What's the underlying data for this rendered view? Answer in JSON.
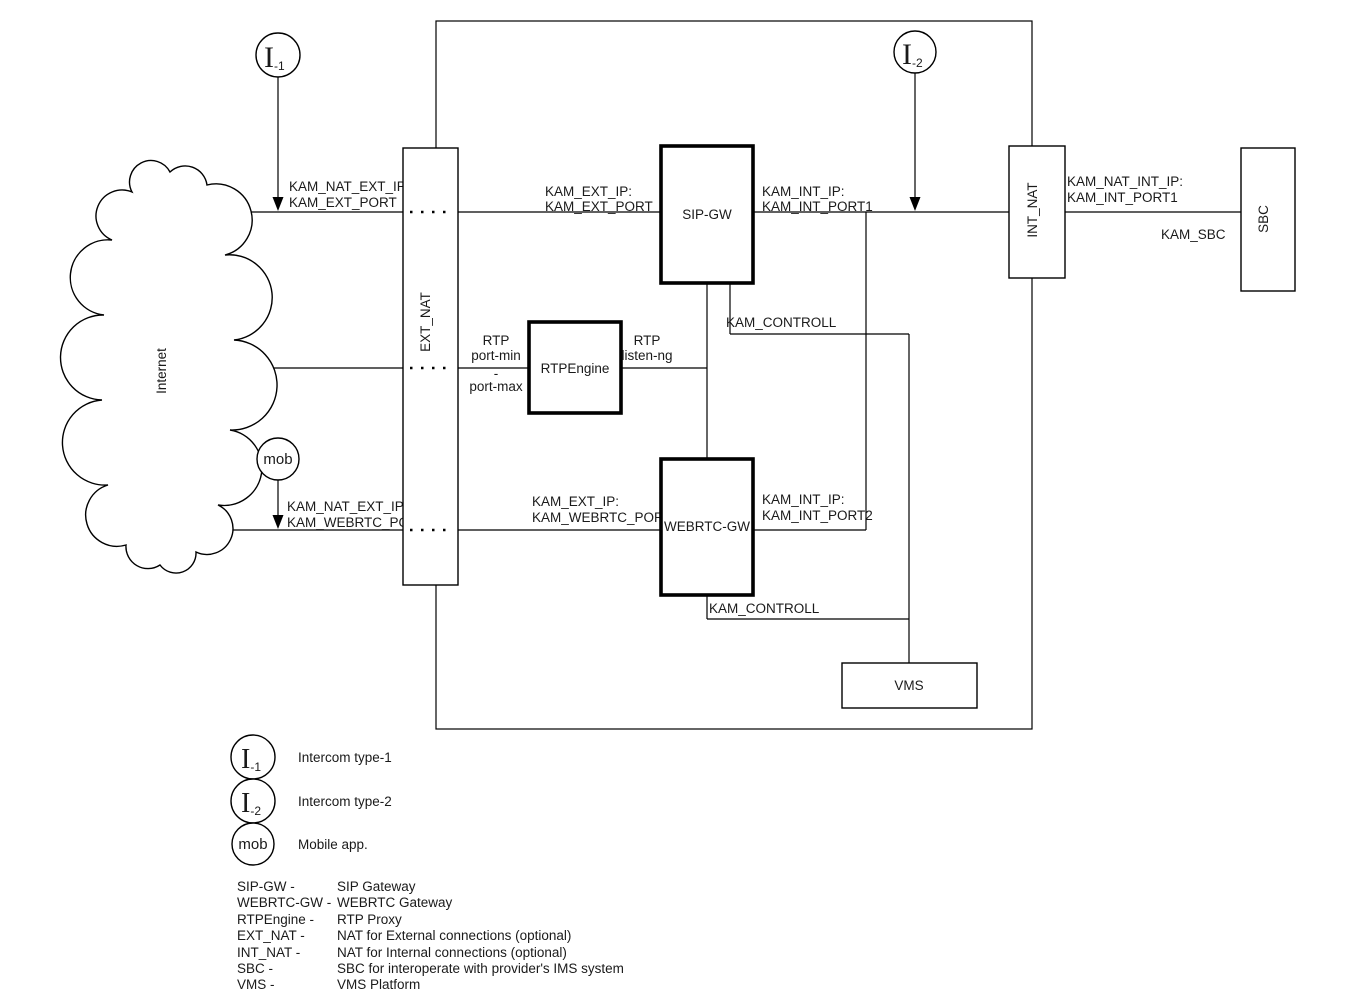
{
  "nodes": {
    "internet": "Internet",
    "ext_nat": "EXT_NAT",
    "sip_gw": "SIP-GW",
    "rtpengine": "RTPEngine",
    "webrtc_gw": "WEBRTC-GW",
    "int_nat": "INT_NAT",
    "sbc": "SBC",
    "vms": "VMS"
  },
  "actors": {
    "intercom1": {
      "symbol": "I",
      "subscript": "-1"
    },
    "intercom2": {
      "symbol": "I",
      "subscript": "-2"
    },
    "mobile": {
      "symbol": "mob"
    }
  },
  "edge_labels": {
    "intercom1_nat": {
      "line1": "KAM_NAT_EXT_IP:",
      "line2": "KAM_EXT_PORT"
    },
    "extnat_sipgw": {
      "line1": "KAM_EXT_IP:",
      "line2": "KAM_EXT_PORT"
    },
    "sipgw_intnat": {
      "line1": "KAM_INT_IP:",
      "line2": "KAM_INT_PORT1"
    },
    "intnat_sbc": {
      "line1": "KAM_NAT_INT_IP:",
      "line2": "KAM_INT_PORT1",
      "line3": "KAM_SBC"
    },
    "sipgw_controll": "KAM_CONTROLL",
    "rtp_left": {
      "line1": "RTP",
      "line2": "port-min",
      "line3": "-",
      "line4": "port-max"
    },
    "rtp_right": {
      "line1": "RTP",
      "line2": "listen-ng"
    },
    "mob_nat": {
      "line1": "KAM_NAT_EXT_IP:",
      "line2": "KAM_WEBRTC_PORT"
    },
    "extnat_webrtcgw": {
      "line1": "KAM_EXT_IP:",
      "line2": "KAM_WEBRTC_PORT"
    },
    "webrtcgw_link": {
      "line1": "KAM_INT_IP:",
      "line2": "KAM_INT_PORT2"
    },
    "webrtcgw_controll": "KAM_CONTROLL"
  },
  "legend": {
    "actors": [
      {
        "symbol": "I",
        "subscript": "-1",
        "label": "Intercom type-1"
      },
      {
        "symbol": "I",
        "subscript": "-2",
        "label": "Intercom type-2"
      },
      {
        "symbol": "mob",
        "subscript": "",
        "label": "Mobile app."
      }
    ],
    "terms": [
      {
        "term": "SIP-GW -",
        "description": "SIP Gateway"
      },
      {
        "term": "WEBRTC-GW -",
        "description": "WEBRTC Gateway"
      },
      {
        "term": "RTPEngine -",
        "description": "RTP Proxy"
      },
      {
        "term": "EXT_NAT -",
        "description": "NAT for External connections (optional)"
      },
      {
        "term": "INT_NAT -",
        "description": "NAT for Internal connections (optional)"
      },
      {
        "term": "SBC -",
        "description": " SBC for interoperate with provider's IMS system"
      },
      {
        "term": "VMS -",
        "description": "VMS Platform"
      }
    ]
  },
  "colors": {
    "stroke": "#000000",
    "background": "#ffffff"
  }
}
